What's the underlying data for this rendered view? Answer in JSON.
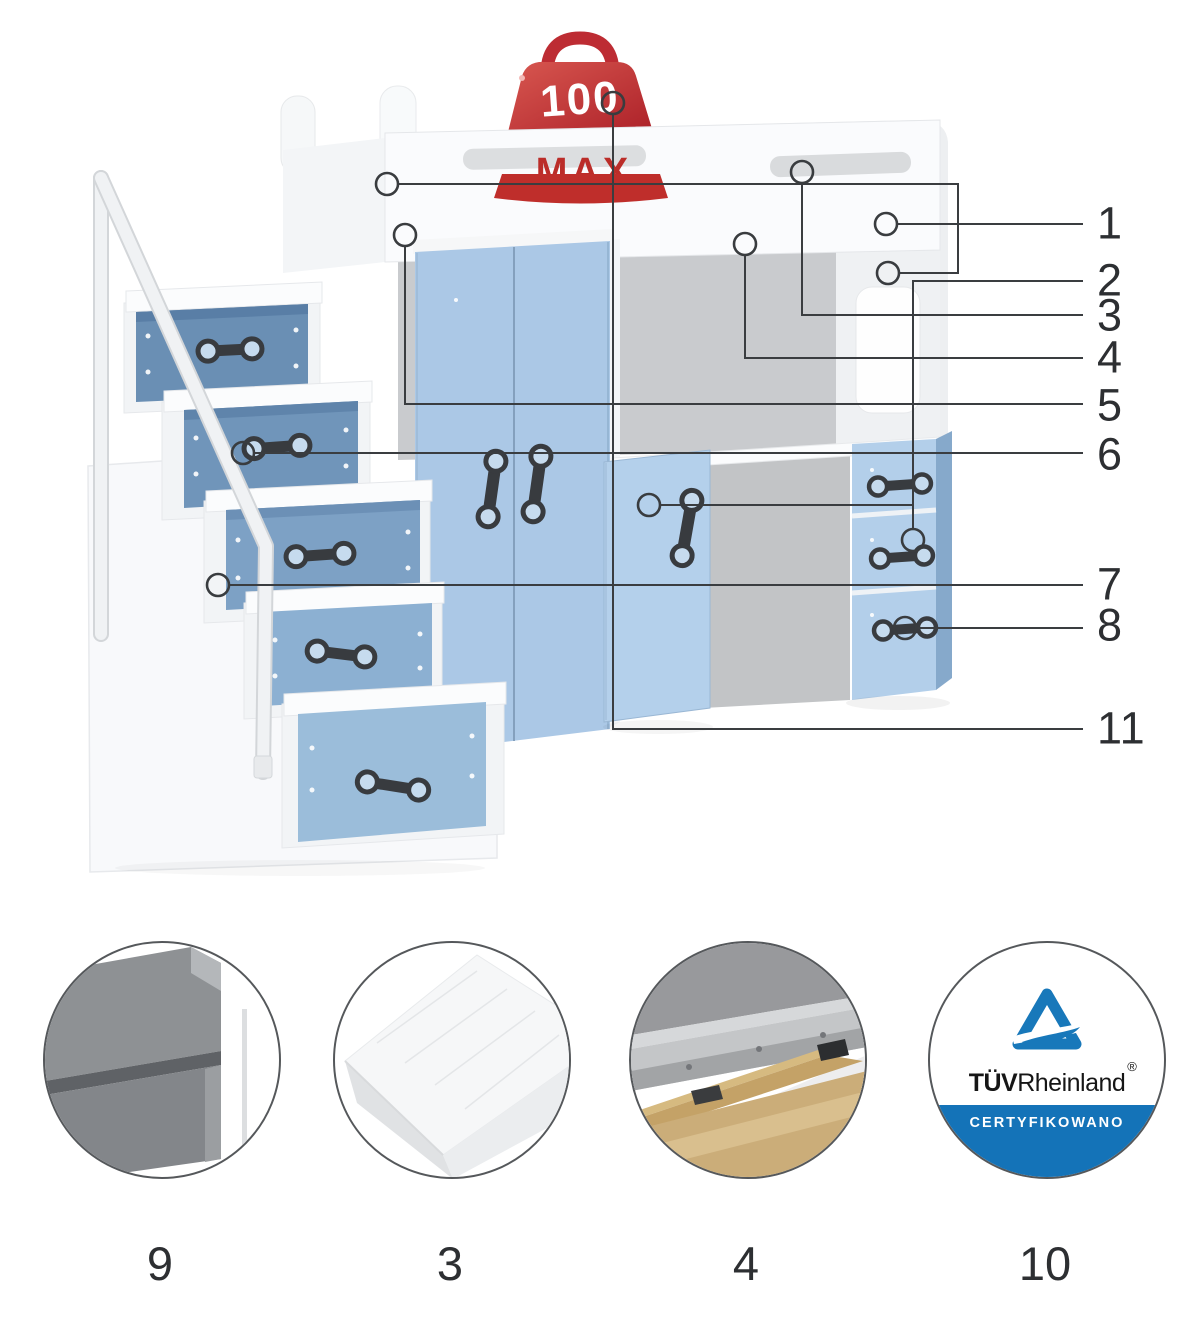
{
  "page": {
    "background": "#ffffff",
    "title": "loft-bed-parts-diagram"
  },
  "badge": {
    "value": "100",
    "label": "MAX",
    "color": "#c12b2f"
  },
  "callouts": [
    {
      "id": "1",
      "label": "1"
    },
    {
      "id": "2",
      "label": "2"
    },
    {
      "id": "3",
      "label": "3"
    },
    {
      "id": "4",
      "label": "4"
    },
    {
      "id": "5",
      "label": "5"
    },
    {
      "id": "6",
      "label": "6"
    },
    {
      "id": "7",
      "label": "7"
    },
    {
      "id": "8",
      "label": "8"
    },
    {
      "id": "11",
      "label": "11"
    }
  ],
  "details": [
    {
      "label": "9",
      "name": "panel-edge-detail"
    },
    {
      "label": "3",
      "name": "mattress-detail"
    },
    {
      "label": "4",
      "name": "slat-frame-detail"
    },
    {
      "label": "10",
      "name": "certificate-detail"
    }
  ],
  "certificate": {
    "brand_bold": "TÜV",
    "brand_rest": "Rheinland",
    "registered": "®",
    "caption": "CERTYFIKOWANO",
    "band_color": "#1473b8"
  },
  "colors": {
    "furniture_blue": "#abc8e6",
    "stair_drawer_blue": "#6e93b8",
    "callout_line": "#3a3d40",
    "badge_red": "#c12b2f",
    "tuv_blue": "#1473b8",
    "wood_tan": "#c4a267"
  }
}
